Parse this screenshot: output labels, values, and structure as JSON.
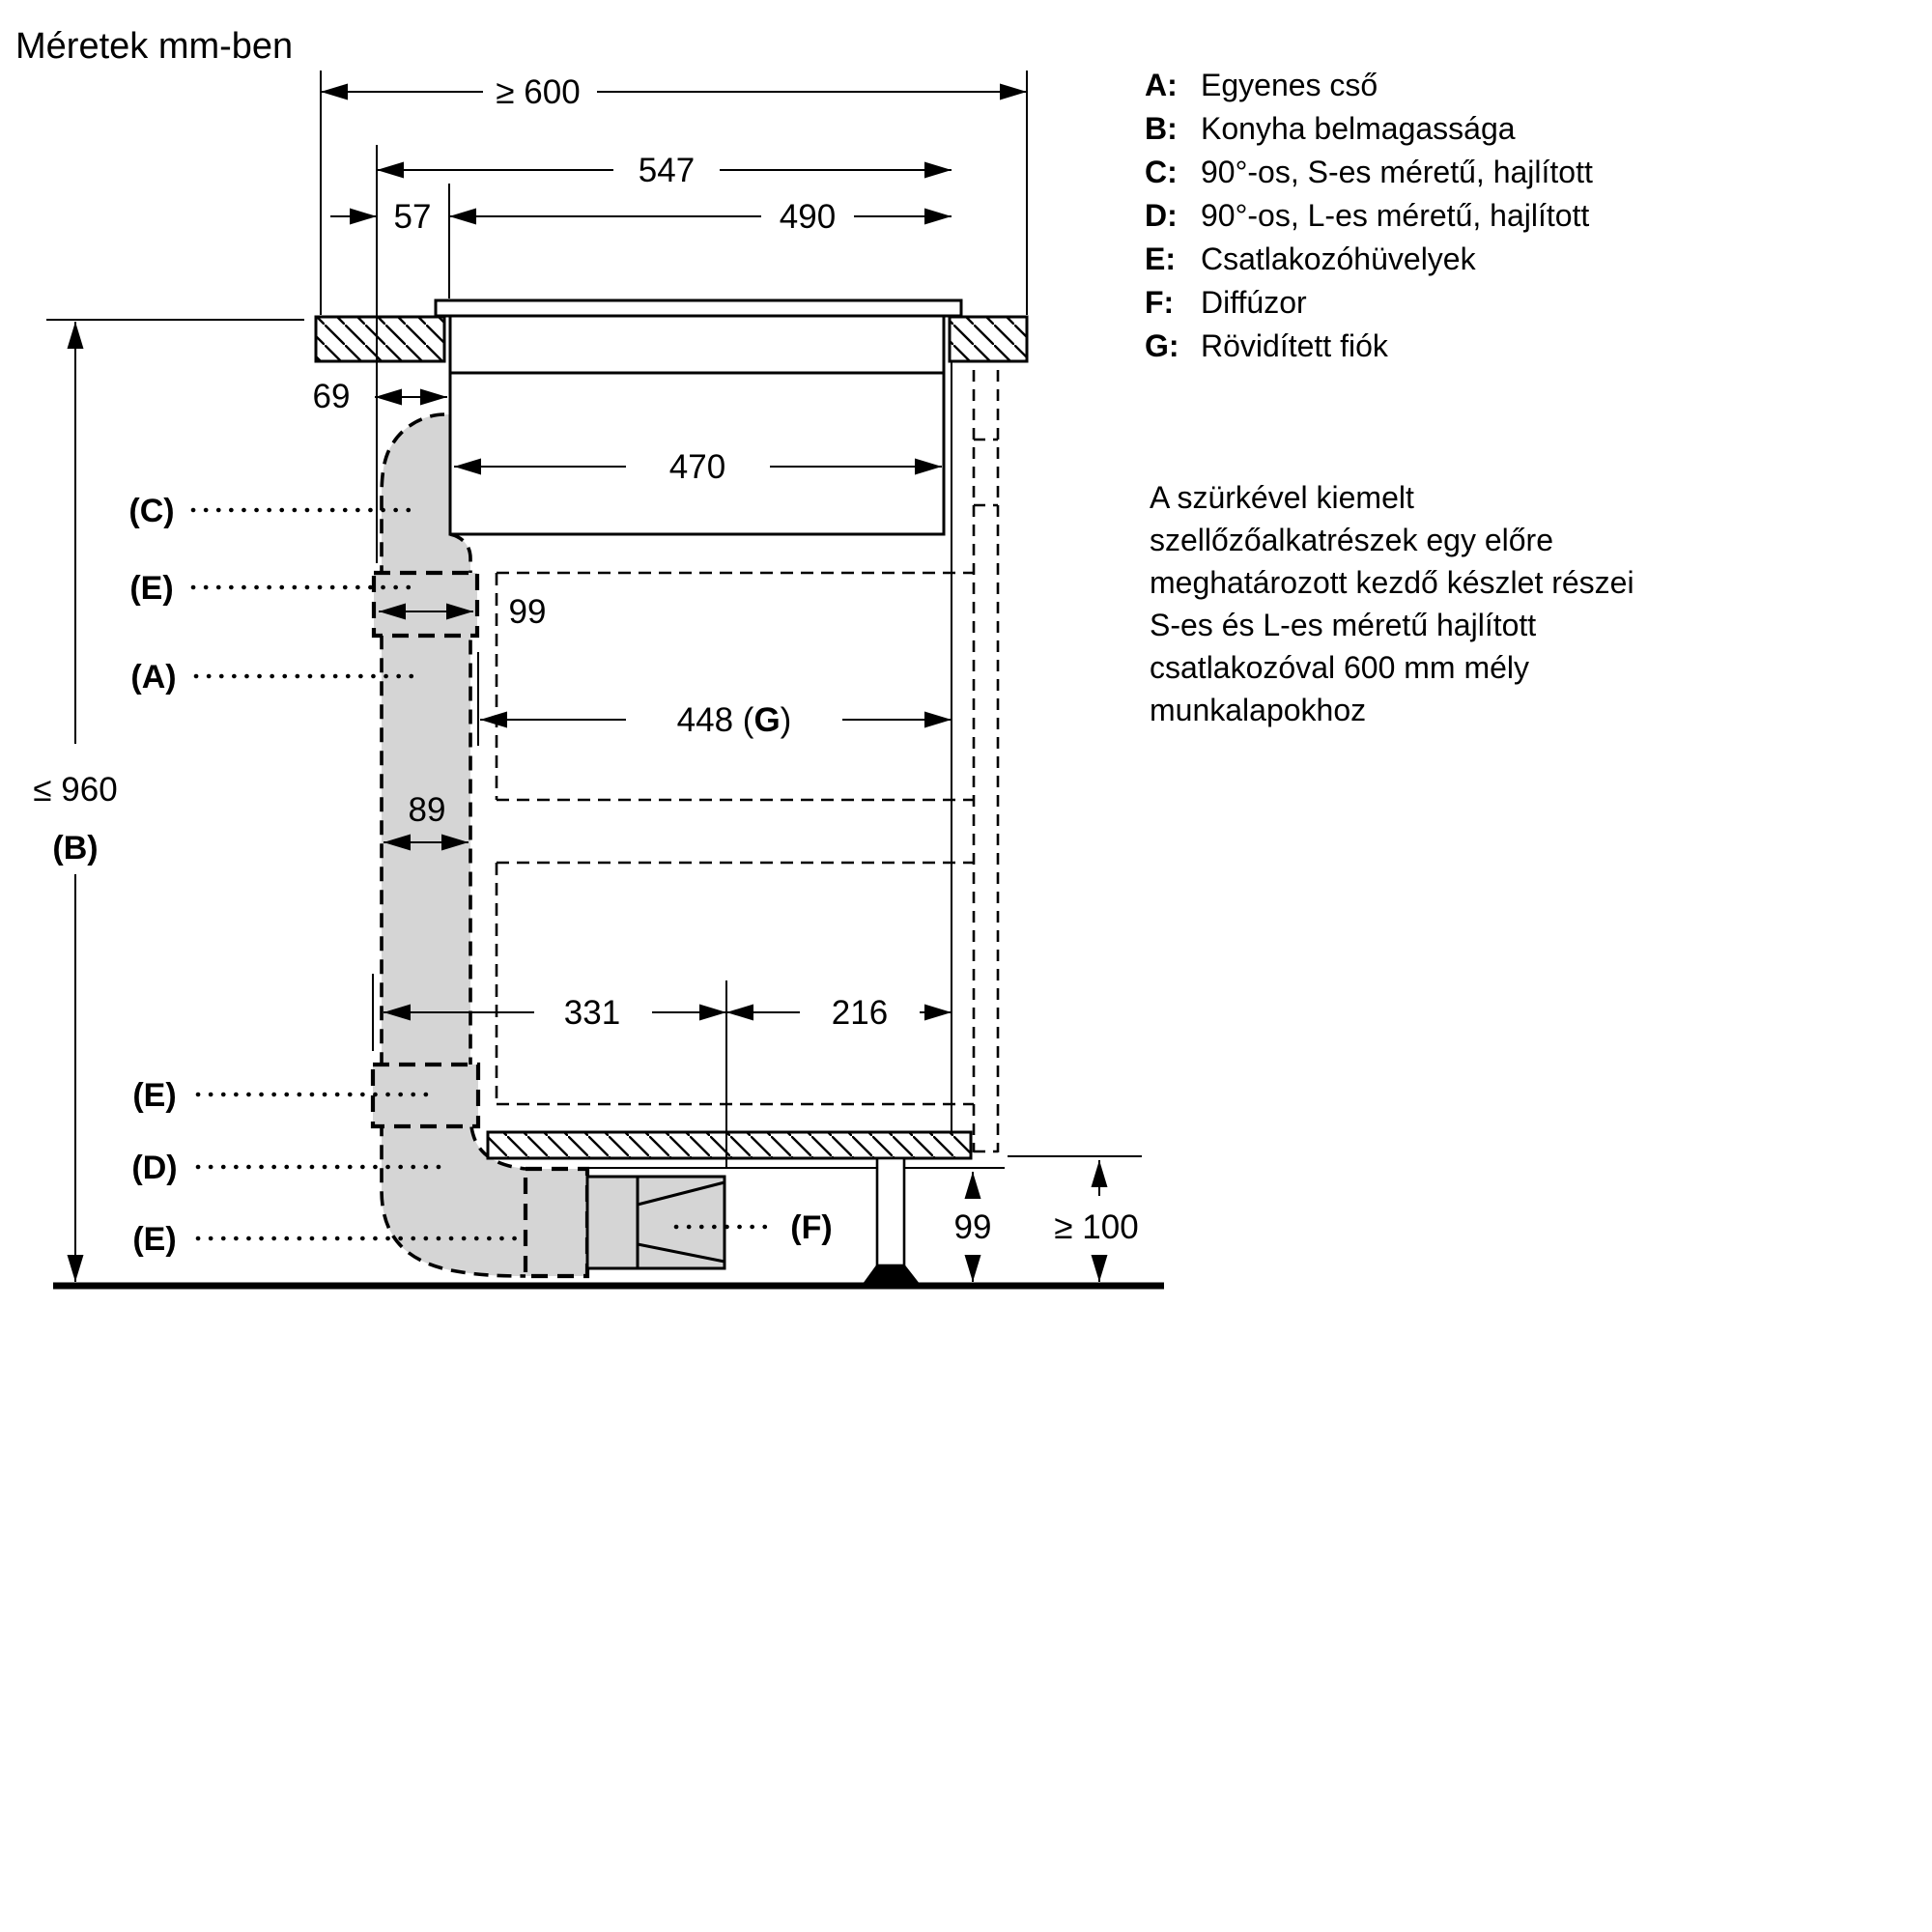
{
  "title": "Méretek mm-ben",
  "legend": {
    "items": [
      {
        "key": "A:",
        "label": "Egyenes cső"
      },
      {
        "key": "B:",
        "label": "Konyha belmagassága"
      },
      {
        "key": "C:",
        "label": "90°-os, S-es méretű, hajlított"
      },
      {
        "key": "D:",
        "label": "90°-os, L-es méretű, hajlított"
      },
      {
        "key": "E:",
        "label": "Csatlakozóhüvelyek"
      },
      {
        "key": "F:",
        "label": "Diffúzor"
      },
      {
        "key": "G:",
        "label": "Rövidített fiók"
      }
    ]
  },
  "note_lines": [
    "A szürkével kiemelt",
    "szellőzőalkatrészek egy előre",
    "meghatározott kezdő készlet részei",
    "S-es és L-es méretű hajlított",
    "csatlakozóval 600 mm mély",
    "munkalapokhoz"
  ],
  "dimensions": {
    "worktop_depth_min": "≥ 600",
    "hob_total_width": "547",
    "front_offset": "57",
    "cutout_width": "490",
    "duct_offset": "69",
    "hob_body_width": "470",
    "sleeve_width": "99",
    "drawer_width": {
      "pre": "448 (",
      "letter": "G",
      "post": ")"
    },
    "duct_width": "89",
    "rear_split": "331",
    "front_split": "216",
    "cabinet_height_max": "≤ 960",
    "cabinet_height_key": "(B)",
    "plinth_height": "99",
    "clearance_min": "≥ 100"
  },
  "part_labels": {
    "c": "(C)",
    "e": "(E)",
    "a": "(A)",
    "d": "(D)",
    "f": "(F)"
  },
  "colors": {
    "ink": "#000000",
    "highlight_gray": "#d5d5d5"
  }
}
